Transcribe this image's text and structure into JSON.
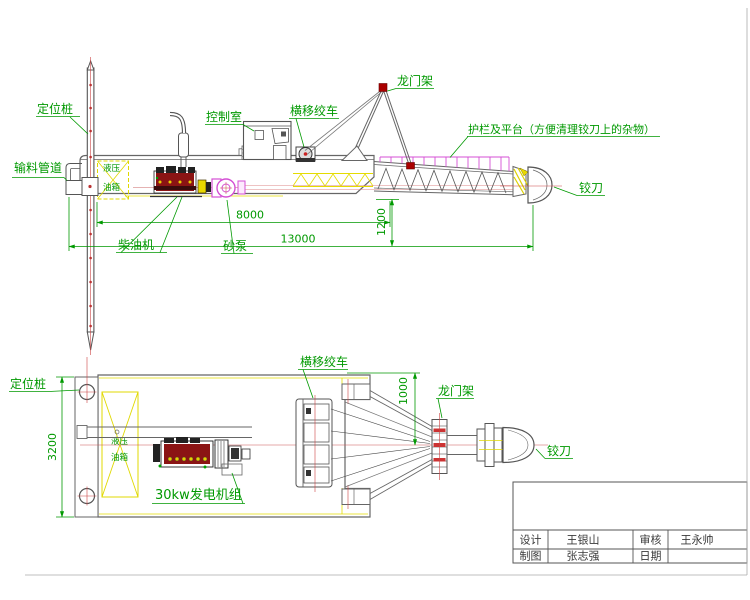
{
  "drawing_type": "cutter suction dredger engineering drawing",
  "colors": {
    "label_green": "#009900",
    "centerline_red": "#cc4444",
    "detail_magenta": "#d44fd4",
    "detail_yellow": "#e0d800",
    "outline_gray": "#666666",
    "engine_red": "#8b1414"
  },
  "side_view": {
    "labels": {
      "spud": "定位桩",
      "feed_pipe": "输料管道",
      "control_room": "控制室",
      "traverse_winch": "横移绞车",
      "gantry": "龙门架",
      "platform_note": "护栏及平台（方便清理铰刀上的杂物）",
      "cutter": "铰刀",
      "diesel_engine": "柴油机",
      "sand_pump": "砂泵",
      "tank_line1": "液压",
      "tank_line2": "油箱"
    },
    "dims": {
      "d8000": "8000",
      "d1200": "1200",
      "d13000": "13000"
    }
  },
  "plan_view": {
    "labels": {
      "spud": "定位桩",
      "traverse_winch": "横移绞车",
      "gantry": "龙门架",
      "cutter": "铰刀",
      "generator": "30kw发电机组",
      "tank_line1": "液压",
      "tank_line2": "油箱"
    },
    "dims": {
      "d3200": "3200",
      "d1000": "1000"
    }
  },
  "title_block": {
    "design_label": "设计",
    "design_name": "王银山",
    "review_label": "审核",
    "review_name": "王永帅",
    "draft_label": "制图",
    "draft_name": "张志强",
    "date_label": "日期",
    "date_value": ""
  }
}
